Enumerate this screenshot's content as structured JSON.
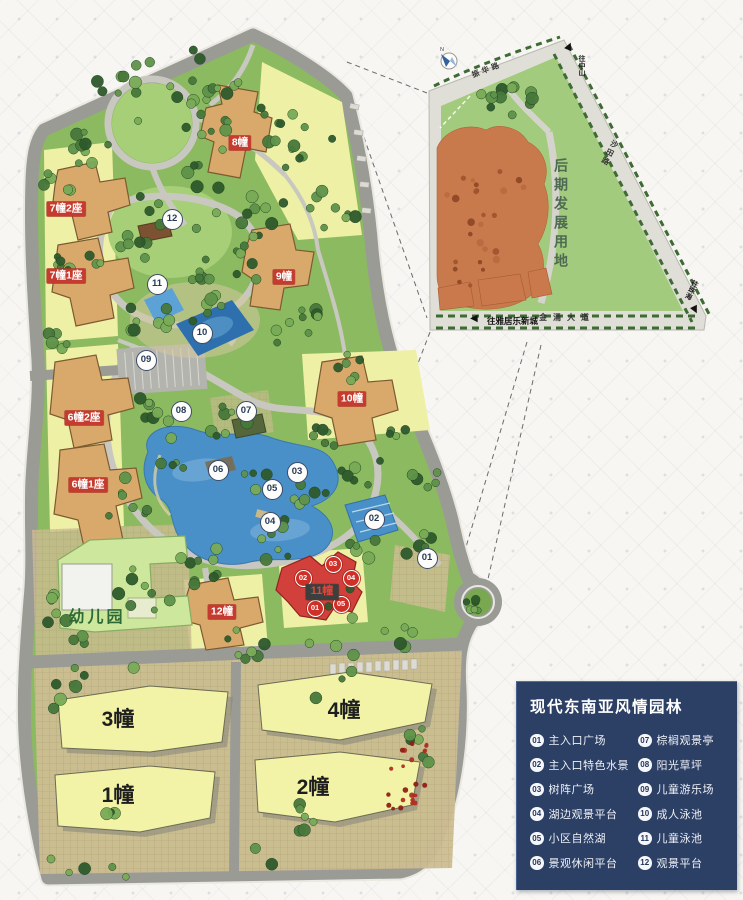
{
  "legend": {
    "title": "现代东南亚风情园林",
    "columns": [
      [
        {
          "num": "01",
          "label": "主入口广场"
        },
        {
          "num": "02",
          "label": "主入口特色水景"
        },
        {
          "num": "03",
          "label": "树阵广场"
        },
        {
          "num": "04",
          "label": "湖边观景平台"
        },
        {
          "num": "05",
          "label": "小区自然湖"
        },
        {
          "num": "06",
          "label": "景观休闲平台"
        }
      ],
      [
        {
          "num": "07",
          "label": "棕榈观景亭"
        },
        {
          "num": "08",
          "label": "阳光草坪"
        },
        {
          "num": "09",
          "label": "儿童游乐场"
        },
        {
          "num": "10",
          "label": "成人泳池"
        },
        {
          "num": "11",
          "label": "儿童泳池"
        },
        {
          "num": "12",
          "label": "观景平台"
        }
      ]
    ]
  },
  "plan": {
    "markers": [
      {
        "num": "01",
        "x": 427,
        "y": 558
      },
      {
        "num": "02",
        "x": 374,
        "y": 519
      },
      {
        "num": "03",
        "x": 297,
        "y": 472
      },
      {
        "num": "04",
        "x": 270,
        "y": 522
      },
      {
        "num": "05",
        "x": 272,
        "y": 489
      },
      {
        "num": "06",
        "x": 218,
        "y": 470
      },
      {
        "num": "07",
        "x": 246,
        "y": 411
      },
      {
        "num": "08",
        "x": 181,
        "y": 411
      },
      {
        "num": "09",
        "x": 146,
        "y": 360
      },
      {
        "num": "10",
        "x": 202,
        "y": 333
      },
      {
        "num": "11",
        "x": 157,
        "y": 284
      },
      {
        "num": "12",
        "x": 172,
        "y": 219
      }
    ],
    "unit_markers": [
      {
        "num": "01",
        "x": 315,
        "y": 608
      },
      {
        "num": "02",
        "x": 303,
        "y": 578
      },
      {
        "num": "03",
        "x": 333,
        "y": 564
      },
      {
        "num": "04",
        "x": 351,
        "y": 578
      },
      {
        "num": "05",
        "x": 341,
        "y": 604
      }
    ],
    "building_labels": [
      {
        "text": "8幢",
        "x": 240,
        "y": 143,
        "kind": "red"
      },
      {
        "text": "7幢2座",
        "x": 66,
        "y": 209,
        "kind": "red"
      },
      {
        "text": "7幢1座",
        "x": 66,
        "y": 276,
        "kind": "red"
      },
      {
        "text": "9幢",
        "x": 284,
        "y": 277,
        "kind": "red"
      },
      {
        "text": "6幢2座",
        "x": 84,
        "y": 418,
        "kind": "red"
      },
      {
        "text": "6幢1座",
        "x": 88,
        "y": 485,
        "kind": "red"
      },
      {
        "text": "10幢",
        "x": 352,
        "y": 399,
        "kind": "red"
      },
      {
        "text": "12幢",
        "x": 222,
        "y": 612,
        "kind": "red"
      },
      {
        "text": "11幢",
        "x": 322,
        "y": 592,
        "kind": "dark"
      },
      {
        "text": "幼儿园",
        "x": 97,
        "y": 618,
        "kind": "green"
      },
      {
        "text": "3幢",
        "x": 118,
        "y": 720,
        "kind": "big"
      },
      {
        "text": "4幢",
        "x": 344,
        "y": 711,
        "kind": "big"
      },
      {
        "text": "1幢",
        "x": 118,
        "y": 796,
        "kind": "big"
      },
      {
        "text": "2幢",
        "x": 313,
        "y": 788,
        "kind": "big"
      }
    ]
  },
  "inset": {
    "land_use_label": "后期发展用地",
    "compass_label": "N",
    "roads": [
      {
        "name": "振华路"
      },
      {
        "name": "沙田路"
      },
      {
        "name": "金涌大道"
      }
    ],
    "directions": [
      {
        "label": "往中山"
      },
      {
        "label": "往珠海"
      },
      {
        "label": "往雅居乐新城"
      }
    ],
    "arrow_up_glyph": "▲",
    "arrow_down_glyph": "▲",
    "arrow_left_glyph": "◀"
  },
  "colors": {
    "legend_bg": "#2c3f64",
    "marker_red": "#ce2f27",
    "label_red": "#c63b2f",
    "lawn_green": "#8cba60",
    "water_blue": "#4a90c8",
    "building_tan": "#d9a96b",
    "parcel_yellow": "#eef0a6",
    "big_building_yellow": "#f2f3a6",
    "dev_orange": "#c97a4c"
  }
}
